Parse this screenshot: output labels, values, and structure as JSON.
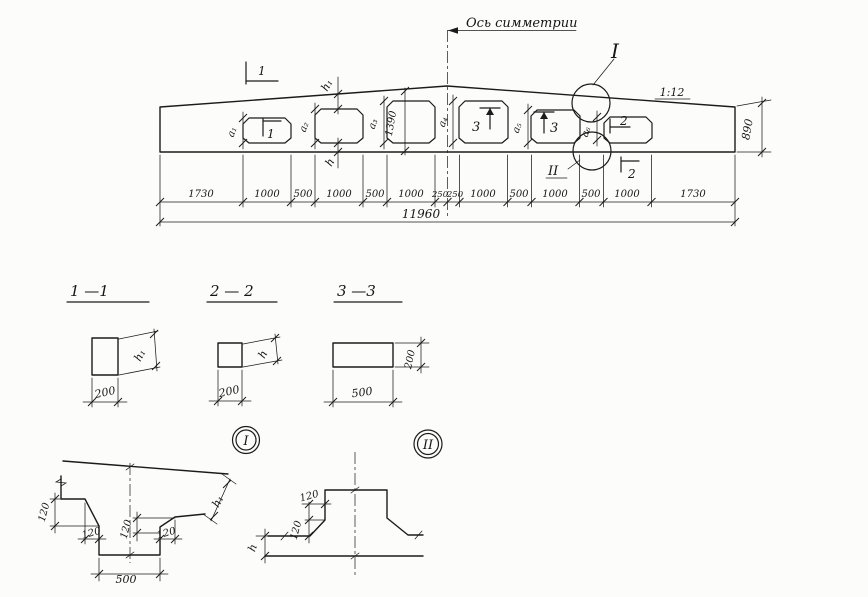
{
  "elevation": {
    "symmetry_axis_label": "Ось симметрии",
    "slope_label": "1:12",
    "height_end": "890",
    "height_mid": "1390",
    "total_length": "11960",
    "dim_chain": [
      "1730",
      "1000",
      "500",
      "1000",
      "500",
      "1000",
      "250",
      "250",
      "1000",
      "500",
      "1000",
      "500",
      "1000",
      "1730"
    ],
    "opening_labels": [
      "a₁",
      "a₂",
      "a₃",
      "a₄",
      "a₅",
      "a₆"
    ],
    "cut_1": "1",
    "cut_2": "2",
    "cut_3": "3",
    "detail_1": "I",
    "detail_2": "II",
    "h1": "h₁",
    "h": "h"
  },
  "sections": {
    "s1": {
      "title": "1 —1",
      "width": "200",
      "height": "h₁"
    },
    "s2": {
      "title": "2 — 2",
      "width": "200",
      "height": "h"
    },
    "s3": {
      "title": "3 —3",
      "width": "500",
      "height": "200"
    }
  },
  "details": {
    "chamfer": "120",
    "d1": {
      "label": "I",
      "post_width": "500",
      "height": "h₁"
    },
    "d2": {
      "label": "II",
      "height": "h"
    }
  },
  "ink_color": "#1b1b1b"
}
